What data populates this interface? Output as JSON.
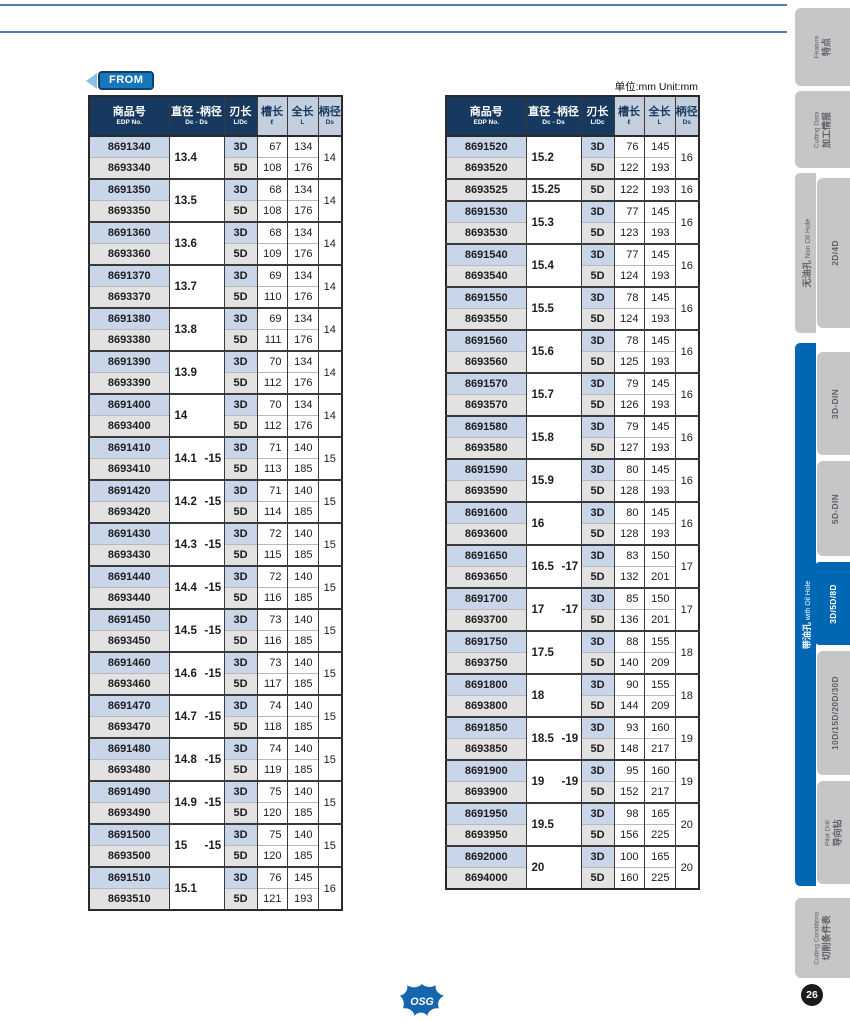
{
  "page": {
    "from_label": "FROM",
    "unit_label": "单位:mm  Unit:mm",
    "page_number": "26",
    "logo_text": "OSG"
  },
  "colors": {
    "accent_blue": "#0067b5",
    "header_navy": "#17395f",
    "cell_blue": "#c9d6e9",
    "cell_gray": "#e2e2e3",
    "rule_blue": "#4e80b0"
  },
  "headers": {
    "edp_zh": "商品号",
    "edp_en": "EDP No.",
    "dia_zh": "直径 -柄径",
    "dia_en": "Dc - Ds",
    "ldc_zh": "刃长",
    "ldc_en": "L/Dc",
    "flute_zh": "槽长",
    "flute_en": "ℓ",
    "oal_zh": "全长",
    "oal_en": "L",
    "shank_zh": "柄径",
    "shank_en": "Ds"
  },
  "left_table": {
    "groups": [
      {
        "d": "13.4",
        "s": "",
        "ds": "14",
        "rows": [
          [
            "8691340",
            "3D",
            "67",
            "134"
          ],
          [
            "8693340",
            "5D",
            "108",
            "176"
          ]
        ]
      },
      {
        "d": "13.5",
        "s": "",
        "ds": "14",
        "rows": [
          [
            "8691350",
            "3D",
            "68",
            "134"
          ],
          [
            "8693350",
            "5D",
            "108",
            "176"
          ]
        ]
      },
      {
        "d": "13.6",
        "s": "",
        "ds": "14",
        "rows": [
          [
            "8691360",
            "3D",
            "68",
            "134"
          ],
          [
            "8693360",
            "5D",
            "109",
            "176"
          ]
        ]
      },
      {
        "d": "13.7",
        "s": "",
        "ds": "14",
        "rows": [
          [
            "8691370",
            "3D",
            "69",
            "134"
          ],
          [
            "8693370",
            "5D",
            "110",
            "176"
          ]
        ]
      },
      {
        "d": "13.8",
        "s": "",
        "ds": "14",
        "rows": [
          [
            "8691380",
            "3D",
            "69",
            "134"
          ],
          [
            "8693380",
            "5D",
            "111",
            "176"
          ]
        ]
      },
      {
        "d": "13.9",
        "s": "",
        "ds": "14",
        "rows": [
          [
            "8691390",
            "3D",
            "70",
            "134"
          ],
          [
            "8693390",
            "5D",
            "112",
            "176"
          ]
        ]
      },
      {
        "d": "14",
        "s": "",
        "ds": "14",
        "rows": [
          [
            "8691400",
            "3D",
            "70",
            "134"
          ],
          [
            "8693400",
            "5D",
            "112",
            "176"
          ]
        ]
      },
      {
        "d": "14.1",
        "s": "-15",
        "ds": "15",
        "rows": [
          [
            "8691410",
            "3D",
            "71",
            "140"
          ],
          [
            "8693410",
            "5D",
            "113",
            "185"
          ]
        ]
      },
      {
        "d": "14.2",
        "s": "-15",
        "ds": "15",
        "rows": [
          [
            "8691420",
            "3D",
            "71",
            "140"
          ],
          [
            "8693420",
            "5D",
            "114",
            "185"
          ]
        ]
      },
      {
        "d": "14.3",
        "s": "-15",
        "ds": "15",
        "rows": [
          [
            "8691430",
            "3D",
            "72",
            "140"
          ],
          [
            "8693430",
            "5D",
            "115",
            "185"
          ]
        ]
      },
      {
        "d": "14.4",
        "s": "-15",
        "ds": "15",
        "rows": [
          [
            "8691440",
            "3D",
            "72",
            "140"
          ],
          [
            "8693440",
            "5D",
            "116",
            "185"
          ]
        ]
      },
      {
        "d": "14.5",
        "s": "-15",
        "ds": "15",
        "rows": [
          [
            "8691450",
            "3D",
            "73",
            "140"
          ],
          [
            "8693450",
            "5D",
            "116",
            "185"
          ]
        ]
      },
      {
        "d": "14.6",
        "s": "-15",
        "ds": "15",
        "rows": [
          [
            "8691460",
            "3D",
            "73",
            "140"
          ],
          [
            "8693460",
            "5D",
            "117",
            "185"
          ]
        ]
      },
      {
        "d": "14.7",
        "s": "-15",
        "ds": "15",
        "rows": [
          [
            "8691470",
            "3D",
            "74",
            "140"
          ],
          [
            "8693470",
            "5D",
            "118",
            "185"
          ]
        ]
      },
      {
        "d": "14.8",
        "s": "-15",
        "ds": "15",
        "rows": [
          [
            "8691480",
            "3D",
            "74",
            "140"
          ],
          [
            "8693480",
            "5D",
            "119",
            "185"
          ]
        ]
      },
      {
        "d": "14.9",
        "s": "-15",
        "ds": "15",
        "rows": [
          [
            "8691490",
            "3D",
            "75",
            "140"
          ],
          [
            "8693490",
            "5D",
            "120",
            "185"
          ]
        ]
      },
      {
        "d": "15",
        "s": "-15",
        "ds": "15",
        "rows": [
          [
            "8691500",
            "3D",
            "75",
            "140"
          ],
          [
            "8693500",
            "5D",
            "120",
            "185"
          ]
        ]
      },
      {
        "d": "15.1",
        "s": "",
        "ds": "16",
        "rows": [
          [
            "8691510",
            "3D",
            "76",
            "145"
          ],
          [
            "8693510",
            "5D",
            "121",
            "193"
          ]
        ]
      }
    ]
  },
  "right_table": {
    "groups": [
      {
        "d": "15.2",
        "s": "",
        "ds": "16",
        "rows": [
          [
            "8691520",
            "3D",
            "76",
            "145"
          ],
          [
            "8693520",
            "5D",
            "122",
            "193"
          ]
        ]
      },
      {
        "d": "15.25",
        "s": "",
        "ds": "16",
        "rows": [
          [
            "8693525",
            "5D",
            "122",
            "193"
          ]
        ]
      },
      {
        "d": "15.3",
        "s": "",
        "ds": "16",
        "rows": [
          [
            "8691530",
            "3D",
            "77",
            "145"
          ],
          [
            "8693530",
            "5D",
            "123",
            "193"
          ]
        ]
      },
      {
        "d": "15.4",
        "s": "",
        "ds": "16",
        "rows": [
          [
            "8691540",
            "3D",
            "77",
            "145"
          ],
          [
            "8693540",
            "5D",
            "124",
            "193"
          ]
        ]
      },
      {
        "d": "15.5",
        "s": "",
        "ds": "16",
        "rows": [
          [
            "8691550",
            "3D",
            "78",
            "145"
          ],
          [
            "8693550",
            "5D",
            "124",
            "193"
          ]
        ]
      },
      {
        "d": "15.6",
        "s": "",
        "ds": "16",
        "rows": [
          [
            "8691560",
            "3D",
            "78",
            "145"
          ],
          [
            "8693560",
            "5D",
            "125",
            "193"
          ]
        ]
      },
      {
        "d": "15.7",
        "s": "",
        "ds": "16",
        "rows": [
          [
            "8691570",
            "3D",
            "79",
            "145"
          ],
          [
            "8693570",
            "5D",
            "126",
            "193"
          ]
        ]
      },
      {
        "d": "15.8",
        "s": "",
        "ds": "16",
        "rows": [
          [
            "8691580",
            "3D",
            "79",
            "145"
          ],
          [
            "8693580",
            "5D",
            "127",
            "193"
          ]
        ]
      },
      {
        "d": "15.9",
        "s": "",
        "ds": "16",
        "rows": [
          [
            "8691590",
            "3D",
            "80",
            "145"
          ],
          [
            "8693590",
            "5D",
            "128",
            "193"
          ]
        ]
      },
      {
        "d": "16",
        "s": "",
        "ds": "16",
        "rows": [
          [
            "8691600",
            "3D",
            "80",
            "145"
          ],
          [
            "8693600",
            "5D",
            "128",
            "193"
          ]
        ]
      },
      {
        "d": "16.5",
        "s": "-17",
        "ds": "17",
        "rows": [
          [
            "8691650",
            "3D",
            "83",
            "150"
          ],
          [
            "8693650",
            "5D",
            "132",
            "201"
          ]
        ]
      },
      {
        "d": "17",
        "s": "-17",
        "ds": "17",
        "rows": [
          [
            "8691700",
            "3D",
            "85",
            "150"
          ],
          [
            "8693700",
            "5D",
            "136",
            "201"
          ]
        ]
      },
      {
        "d": "17.5",
        "s": "",
        "ds": "18",
        "rows": [
          [
            "8691750",
            "3D",
            "88",
            "155"
          ],
          [
            "8693750",
            "5D",
            "140",
            "209"
          ]
        ]
      },
      {
        "d": "18",
        "s": "",
        "ds": "18",
        "rows": [
          [
            "8691800",
            "3D",
            "90",
            "155"
          ],
          [
            "8693800",
            "5D",
            "144",
            "209"
          ]
        ]
      },
      {
        "d": "18.5",
        "s": "-19",
        "ds": "19",
        "rows": [
          [
            "8691850",
            "3D",
            "93",
            "160"
          ],
          [
            "8693850",
            "5D",
            "148",
            "217"
          ]
        ]
      },
      {
        "d": "19",
        "s": "-19",
        "ds": "19",
        "rows": [
          [
            "8691900",
            "3D",
            "95",
            "160"
          ],
          [
            "8693900",
            "5D",
            "152",
            "217"
          ]
        ]
      },
      {
        "d": "19.5",
        "s": "",
        "ds": "20",
        "rows": [
          [
            "8691950",
            "3D",
            "98",
            "165"
          ],
          [
            "8693950",
            "5D",
            "156",
            "225"
          ]
        ]
      },
      {
        "d": "20",
        "s": "",
        "ds": "20",
        "rows": [
          [
            "8692000",
            "3D",
            "100",
            "165"
          ],
          [
            "8694000",
            "5D",
            "160",
            "225"
          ]
        ]
      }
    ]
  },
  "sidebar": {
    "feature": {
      "zh": "特点",
      "en": "Feature"
    },
    "cutting_data": {
      "zh": "加工情报",
      "en": "Cutting Data"
    },
    "non_oil_hole": {
      "zh": "无油孔",
      "en": "Non Oil Hole",
      "tab_2d4d": "2D/4D"
    },
    "with_oil_hole": {
      "zh": "带油孔",
      "en": "with Oil Hole",
      "tab_3d_din": "3D-DIN",
      "tab_5d_din": "5D-DIN",
      "tab_3d5d8d": "3D/5D/8D",
      "tab_10d30d": "10D/15D/20D/30D",
      "pilot": {
        "zh": "导向钻",
        "en": "Pilot Drill"
      }
    },
    "cutting_conditions": {
      "zh": "切削条件表",
      "en": "Cutting Conditions"
    }
  }
}
